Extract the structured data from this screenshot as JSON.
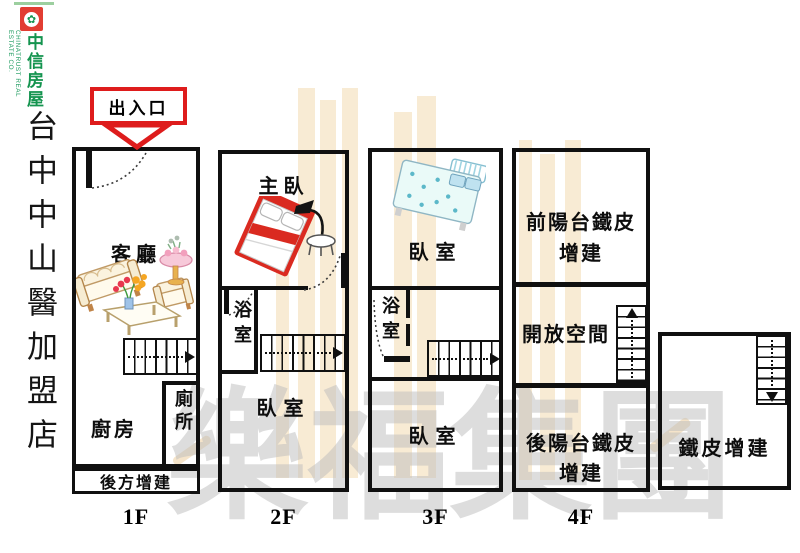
{
  "brand": {
    "logo_symbol": "✿",
    "name_en": "CHINATRUST REAL ESTATE CO.",
    "name_zh": "中信房屋",
    "store_name": "台中中山醫加盟店",
    "red": "#e23d32",
    "green": "#14944f"
  },
  "entrance": {
    "label": "出入口",
    "color": "#de1c1c"
  },
  "floors": [
    {
      "label": "1F",
      "rooms": {
        "living": "客廳",
        "kitchen": "廚房",
        "toilet": "廁所"
      },
      "annex": "後方增建"
    },
    {
      "label": "2F",
      "rooms": {
        "master": "主臥",
        "bath": "浴室",
        "bedroom": "臥室"
      }
    },
    {
      "label": "3F",
      "rooms": {
        "bedroom_top": "臥室",
        "bath": "浴室",
        "bedroom_bottom": "臥室"
      }
    },
    {
      "label": "4F",
      "rooms": {
        "front_balcony": "前陽台鐵皮增建",
        "open_space": "開放空間",
        "rear_balcony": "後陽台鐵皮增建"
      }
    }
  ],
  "rooftop": {
    "label": "鐵皮增建"
  },
  "watermark": {
    "text": "樂福集團"
  }
}
